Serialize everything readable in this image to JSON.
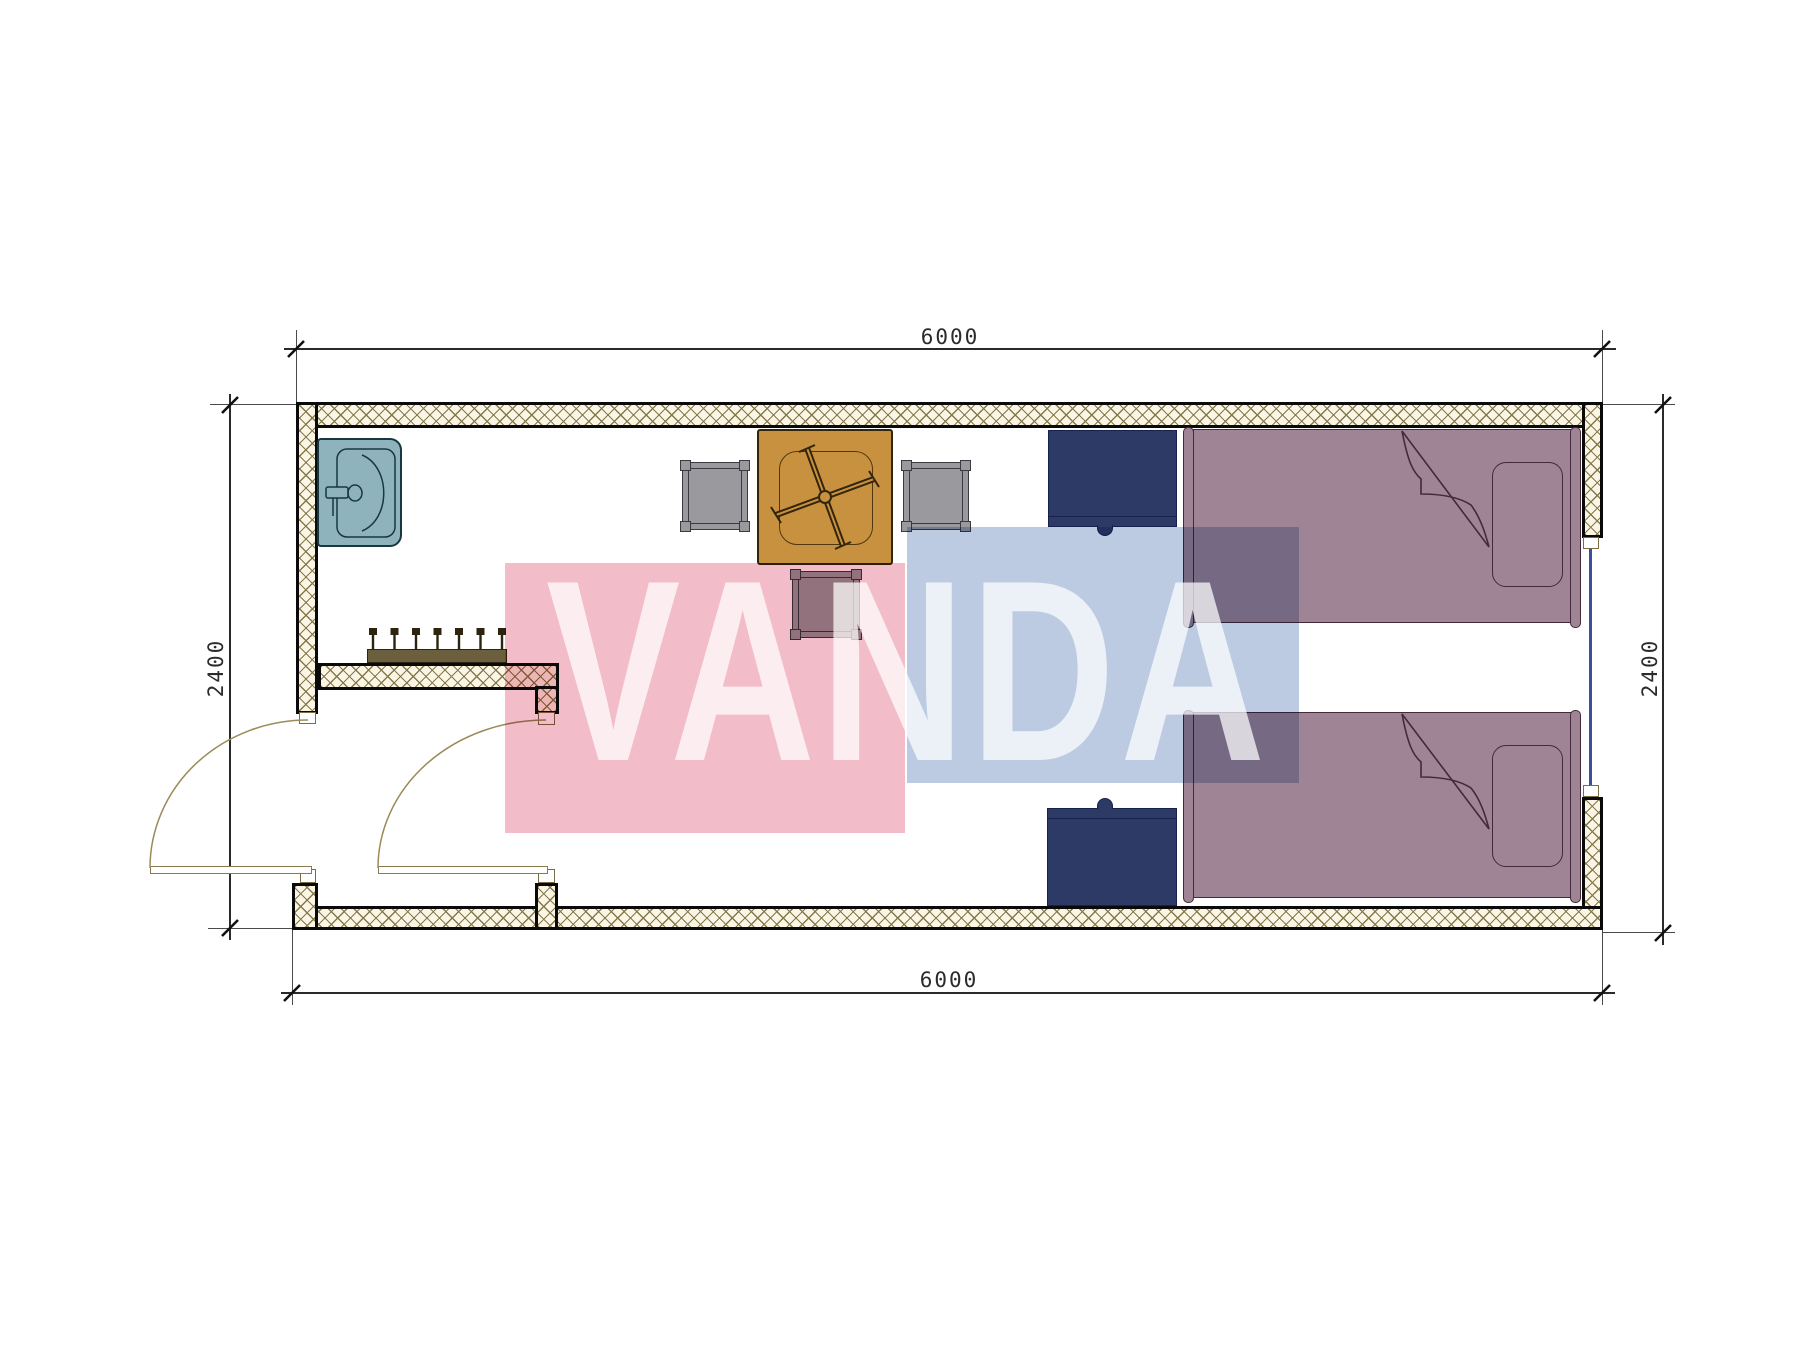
{
  "dimensions": {
    "top": "6000",
    "bottom": "6000",
    "left": "2400",
    "right": "2400"
  },
  "watermark": {
    "text": "VANDA"
  },
  "colors": {
    "wall_fill": "#faf5e4",
    "wall_hatch": "#86784a",
    "outline": "#0a0a0a",
    "sink": "#8fb3bd",
    "sink_line": "#173741",
    "table": "#c8913f",
    "table_line": "#32250c",
    "chair": "#9a9a9e",
    "chair_line": "#3a3a40",
    "bed": "#9e8495",
    "bed_line": "#44293a",
    "navy": "#2e3a66",
    "navy_line": "#16224d",
    "rack": "#6b5f3e",
    "rack_line": "#2c2410",
    "door_line": "#9b8a58",
    "window_glass": "#3a4fa0",
    "dim_line": "#2a2a2a",
    "dim_text": "#2b2b2b",
    "wm_pink": "#f2bdc8",
    "wm_blue": "#bccbe2",
    "wm_text": "rgba(255,255,255,0.72)"
  }
}
